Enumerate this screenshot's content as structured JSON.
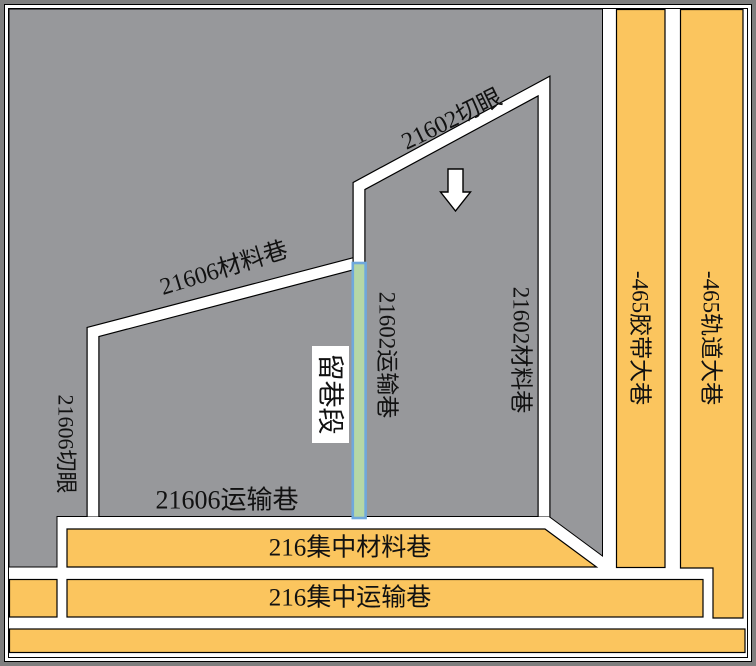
{
  "colors": {
    "panel_gray": "#97989B",
    "roadway_orange": "#FBC55E",
    "retained_fill": "#B5D7A6",
    "retained_border": "#6FA8DC",
    "retained_label_color": "#6FA8DC",
    "arrow_fill": "#FFFFFF",
    "label_black": "#111111"
  },
  "labels": {
    "cut_21602": "21602切眼",
    "transport_21602": "21602运输巷",
    "material_21602": "21602材料巷",
    "material_21606": "21606材料巷",
    "cut_21606": "21606切眼",
    "transport_21606": "21606运输巷",
    "retained_section": "留巷段",
    "central_material_216": "216集中材料巷",
    "central_transport_216": "216集中运输巷",
    "belt_main_465": "-465胶带大巷",
    "track_main_465": "-465轨道大巷"
  }
}
